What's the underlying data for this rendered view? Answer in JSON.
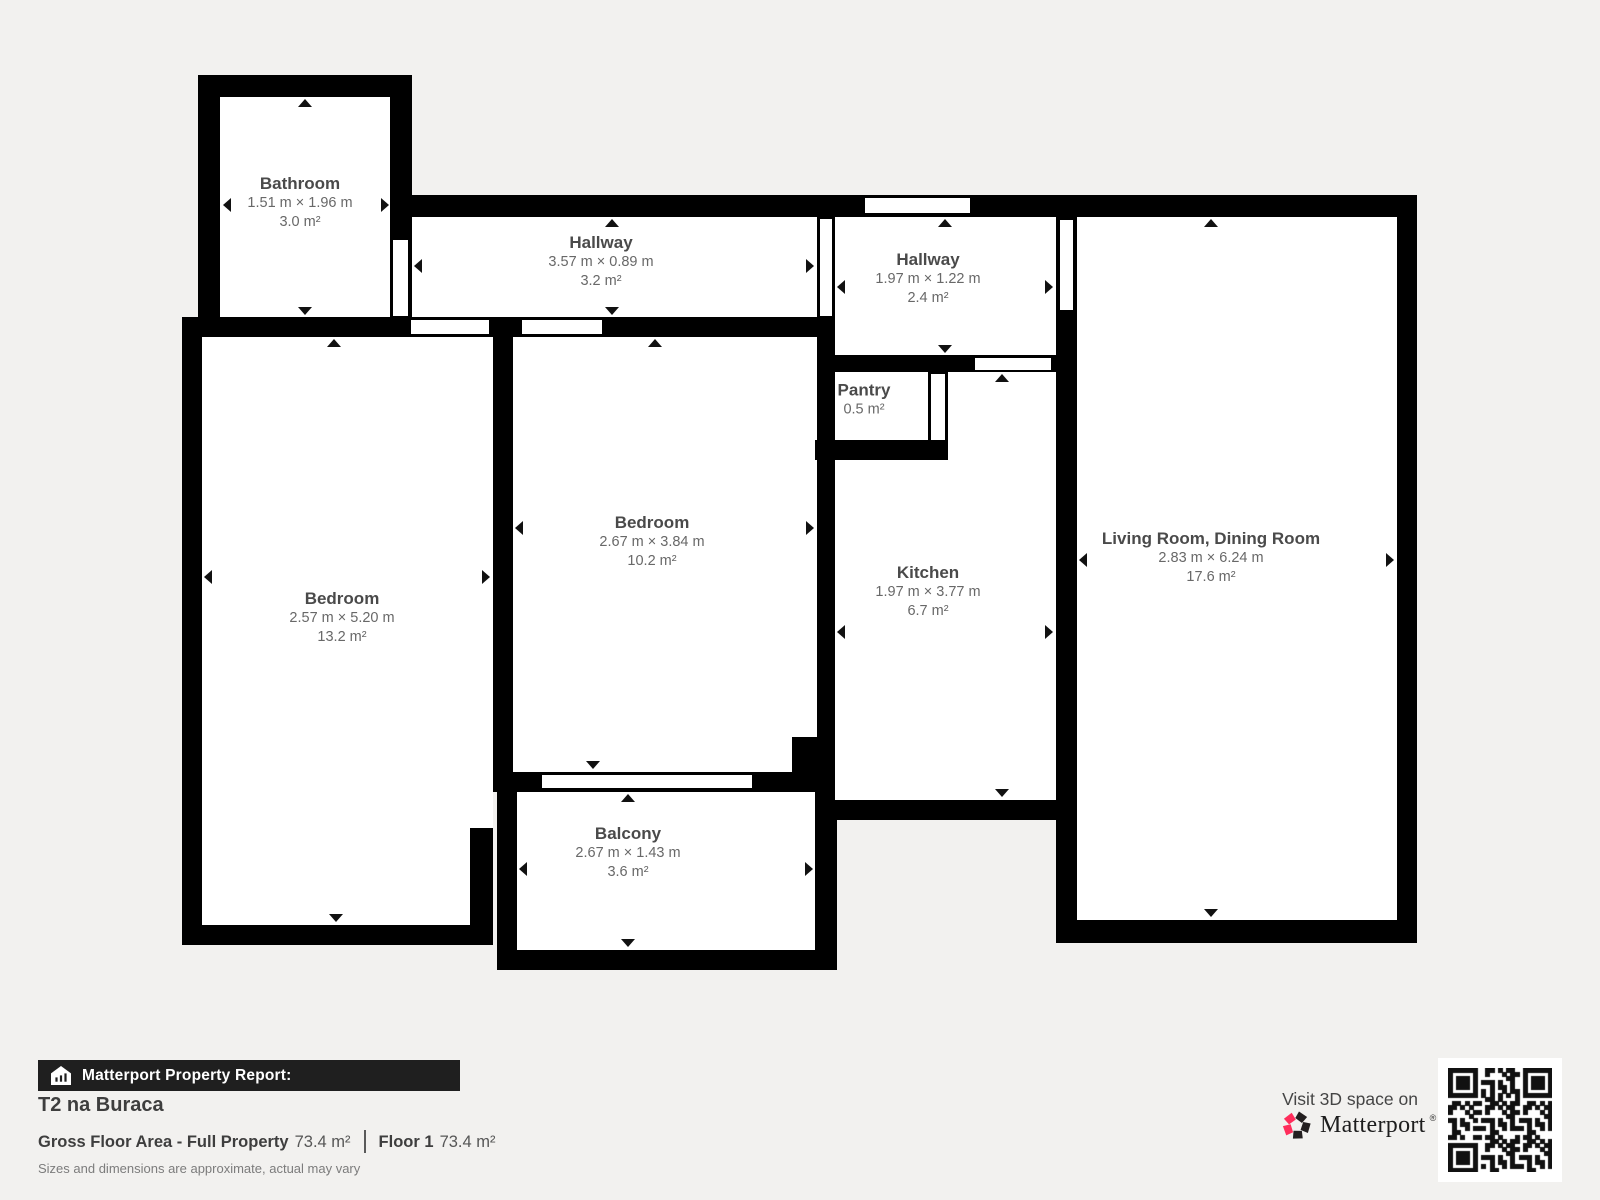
{
  "plan": {
    "rooms": [
      {
        "id": "bathroom",
        "name": "Bathroom",
        "dims": "1.51 m × 1.96 m",
        "area": "3.0 m²"
      },
      {
        "id": "hallway-top",
        "name": "Hallway",
        "dims": "3.57 m × 0.89 m",
        "area": "3.2 m²"
      },
      {
        "id": "hallway-entry",
        "name": "Hallway",
        "dims": "1.97 m × 1.22 m",
        "area": "2.4 m²"
      },
      {
        "id": "pantry",
        "name": "Pantry",
        "dims": null,
        "area": "0.5 m²"
      },
      {
        "id": "bedroom-middle",
        "name": "Bedroom",
        "dims": "2.67 m × 3.84 m",
        "area": "10.2 m²"
      },
      {
        "id": "bedroom-left",
        "name": "Bedroom",
        "dims": "2.57 m × 5.20 m",
        "area": "13.2 m²"
      },
      {
        "id": "kitchen",
        "name": "Kitchen",
        "dims": "1.97 m × 3.77 m",
        "area": "6.7 m²"
      },
      {
        "id": "living-dining",
        "name": "Living Room, Dining Room",
        "dims": "2.83 m × 6.24 m",
        "area": "17.6 m²"
      },
      {
        "id": "balcony",
        "name": "Balcony",
        "dims": "2.67 m × 1.43 m",
        "area": "3.6 m²"
      }
    ]
  },
  "footer": {
    "report_label": "Matterport Property Report:",
    "property_name": "T2 na Buraca",
    "gfa_label": "Gross Floor Area - Full Property",
    "gfa_value": "73.4 m²",
    "floor_label": "Floor 1",
    "floor_value": "73.4 m²",
    "disclaimer": "Sizes and dimensions are approximate, actual may vary"
  },
  "cta": {
    "visit_label": "Visit 3D space on",
    "brand": "Matterport",
    "reg_mark": "®"
  },
  "colors": {
    "background": "#f2f1ef",
    "wall": "#000000",
    "room_fill": "#ffffff",
    "brand_pink": "#ff2d5b",
    "brand_black": "#231f20",
    "bar_bg": "#1f1f1f"
  }
}
